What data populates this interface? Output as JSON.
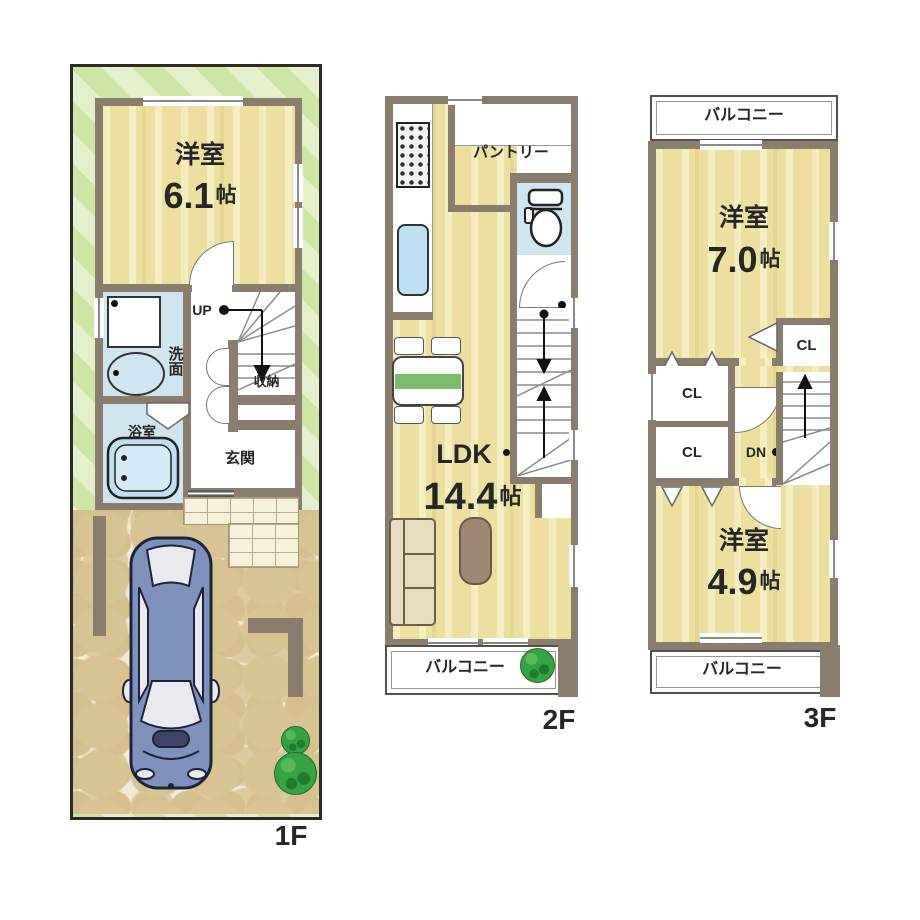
{
  "title": "木造3階建て住宅 間取り図",
  "colors": {
    "wall": "#8b7d6d",
    "wood_floor": "#ecdf9f",
    "wet_floor": "#cfe5f0",
    "lot_green_a": "#cfe5a6",
    "lot_green_b": "#e4f0cd",
    "driveway_base": "#f2ebd5",
    "driveway_stone": "#d8c394",
    "shrub_green": "#36a244",
    "car_body": "#7f92bc",
    "table_green": "#7cbd6d"
  },
  "floor1": {
    "tag": "1F",
    "room_name": "洋室",
    "room_size": "6.1",
    "room_unit": "帖",
    "washroom": "洗面",
    "bathroom": "浴室",
    "entrance": "玄関",
    "up": "UP",
    "storage": "収納"
  },
  "floor2": {
    "tag": "2F",
    "pantry": "パントリー",
    "ldk_name": "LDK",
    "ldk_size": "14.4",
    "ldk_unit": "帖",
    "balcony": "バルコニー"
  },
  "floor3": {
    "tag": "3F",
    "balcony_top": "バルコニー",
    "room1_name": "洋室",
    "room1_size": "7.0",
    "room1_unit": "帖",
    "closet1": "CL",
    "closet2": "CL",
    "closet3": "CL",
    "dn": "DN",
    "room2_name": "洋室",
    "room2_size": "4.9",
    "room2_unit": "帖",
    "balcony_bottom": "バルコニー"
  }
}
